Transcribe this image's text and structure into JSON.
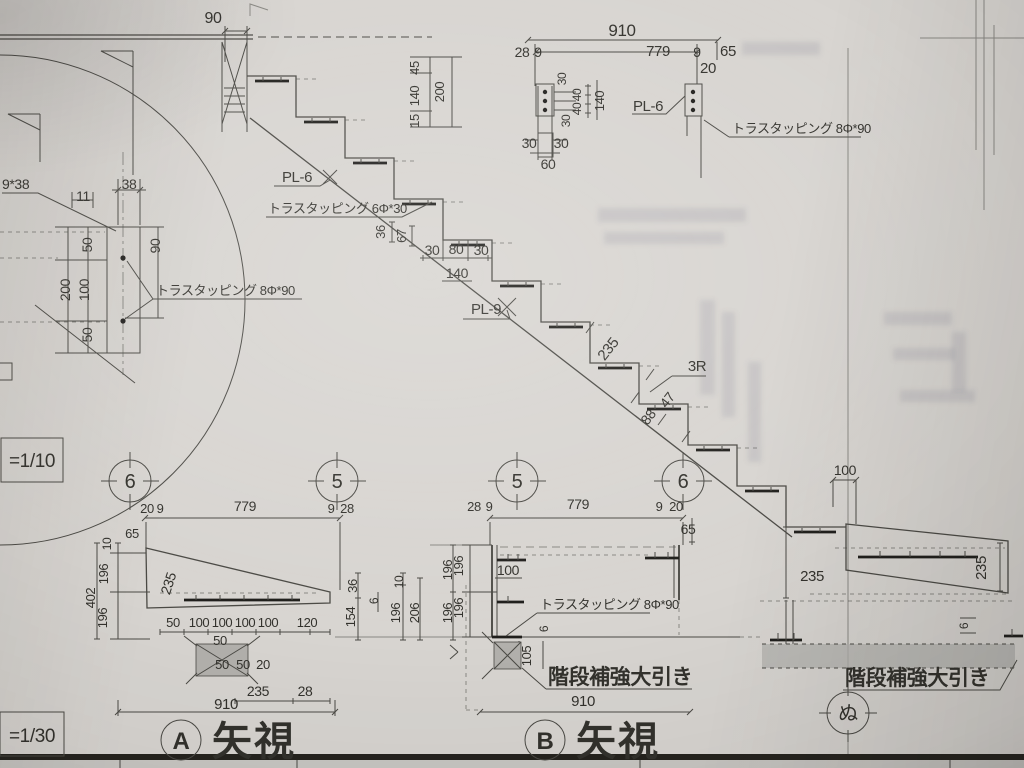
{
  "colors": {
    "paper": "#d8d5d1",
    "line": "#4b4a45",
    "heavy": "#201f1c",
    "ink": "#33322d",
    "shade": "#b3b1ad",
    "ghost": "#70708a"
  },
  "sheet": {
    "scale_detail": "=1/10",
    "scale_view": "=1/30"
  },
  "views": {
    "a": {
      "balloon": "A",
      "title": "矢視"
    },
    "b": {
      "balloon": "B",
      "title": "矢視"
    }
  },
  "balloons": {
    "g1": "6",
    "g2": "5",
    "g3": "5",
    "g4": "6",
    "axis_nu": "ぬ"
  },
  "top_detail": {
    "total": "910",
    "run": "779",
    "seg_28": "28",
    "seg_9l": "9",
    "seg_9r": "9",
    "seg_65": "65",
    "seg_20": "20",
    "h45": "45",
    "h140": "140",
    "h15": "15",
    "h200": "200",
    "b30t": "30",
    "b40a": "40",
    "b40b": "40",
    "b140": "140",
    "b30b": "30",
    "w30l": "30",
    "w30r": "30",
    "w60": "60",
    "pl6": "PL-6",
    "tapping": "トラスタッピング 8Φ*90"
  },
  "stair": {
    "dim90": "90",
    "pl6": "PL-6",
    "tapping6": "トラスタッピング 6Φ*30",
    "v36": "36",
    "v67": "67",
    "h30l": "30",
    "h80": "80",
    "h30r": "30",
    "h140": "140",
    "pl9": "PL-9",
    "d235": "235",
    "r3": "3R",
    "d88": "88",
    "d47": "47"
  },
  "left_detail": {
    "screw": "9*38",
    "d11": "11",
    "d38": "38",
    "d90": "90",
    "d50t": "50",
    "d200": "200",
    "d100": "100",
    "d50b": "50",
    "tapping": "トラスタッピング 8Φ*90"
  },
  "view_a": {
    "c20": "20",
    "c9l": "9",
    "c779": "779",
    "c9r": "9",
    "c28": "28",
    "d65": "65",
    "d10": "10",
    "d196t": "196",
    "d402": "402",
    "d196b": "196",
    "d235": "235",
    "r50": "50",
    "r100a": "100",
    "r100b": "100",
    "r100c": "100",
    "r100d": "100",
    "r120": "120",
    "s50": "50",
    "s50a": "50",
    "s50b": "50",
    "s20": "20",
    "s235": "235",
    "s28": "28",
    "total": "910",
    "m36": "36",
    "m154": "154",
    "m6": "6",
    "m10": "10",
    "m196a": "196",
    "m206": "206",
    "m196b": "196",
    "m196c": "196"
  },
  "view_b": {
    "c28": "28",
    "c9l": "9",
    "c779": "779",
    "c9r": "9",
    "c20": "20",
    "d65": "65",
    "d196t": "196",
    "d196b": "196",
    "d100": "100",
    "tapping": "トラスタッピング 8Φ*90",
    "d6": "6",
    "d105": "105",
    "joist": "階段補強大引き",
    "total": "910"
  },
  "right_detail": {
    "d100": "100",
    "d235l": "235",
    "d235r": "235",
    "d6": "6",
    "joist": "階段補強大引き"
  }
}
